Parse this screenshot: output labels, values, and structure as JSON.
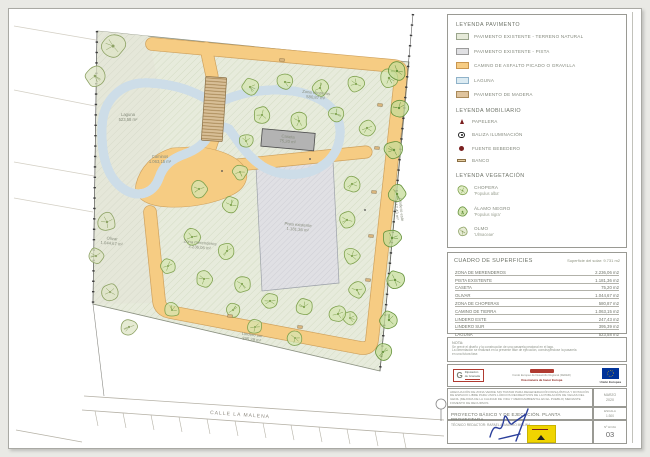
{
  "legend_pavimento": {
    "title": "LEYENDA PAVIMENTO",
    "items": [
      {
        "label": "PAVIMENTO EXISTENTE - TERRENO NATURAL",
        "color": "#e6ead9",
        "border": "#9aa58c"
      },
      {
        "label": "PAVIMENTO EXISTENTE - PISTA",
        "color": "#e0e0e3",
        "border": "#9b9b9b"
      },
      {
        "label": "CAMINO DE ASFALTO PICADO O GRAVILLA",
        "color": "#f6cc83",
        "border": "#c9964f"
      },
      {
        "label": "LAGUNA",
        "color": "#dcebf2",
        "border": "#8fb2c9"
      },
      {
        "label": "PAVIMENTO DE MADERA",
        "color": "#dfc49e",
        "border": "#a98a5a"
      }
    ]
  },
  "legend_mobiliario": {
    "title": "LEYENDA MOBILIARIO",
    "items": [
      {
        "label": "PAPELERA",
        "icon": "papelera-icon",
        "color": "#7a1f1f"
      },
      {
        "label": "BALIZA ILUMINACIÓN",
        "icon": "baliza-icon",
        "color": "#222222"
      },
      {
        "label": "FUENTE BEBEDERO",
        "icon": "fuente-icon",
        "color": "#7a1f1f"
      },
      {
        "label": "BANCO",
        "icon": "banco-icon",
        "color": "#caa36a"
      }
    ]
  },
  "legend_vegetacion": {
    "title": "LEYENDA VEGETACIÓN",
    "items": [
      {
        "label": "CHOPERA",
        "sublabel": "'Populus alba'",
        "type": "c"
      },
      {
        "label": "ÁLAMO NEGRO",
        "sublabel": "'Populus nigra'",
        "type": "a"
      },
      {
        "label": "OLMO",
        "sublabel": "'Ulmaceae'",
        "type": "o"
      }
    ]
  },
  "surfaces": {
    "title": "CUADRO DE SUPERFICIES",
    "subtitle": "Superficie del solar: 9.731 m2",
    "rows": [
      {
        "label": "ZONA DE MERENDEROS",
        "value": "2.236,06 m2"
      },
      {
        "label": "PISTA EXISTENTE",
        "value": "1.181,36 m2"
      },
      {
        "label": "CASETA",
        "value": "75,20 m2"
      },
      {
        "label": "OLIVAR",
        "value": "1.044,67 m2"
      },
      {
        "label": "ZONA DE CHOPERAS",
        "value": "580,87 m2"
      },
      {
        "label": "CAMINO DE TIERRA",
        "value": "1.063,15 m2"
      },
      {
        "label": "LINDERO ESTE",
        "value": "247,43 m2"
      },
      {
        "label": "LINDERO SUR",
        "value": "395,39 m2"
      },
      {
        "label": "LAGUNA",
        "value": "523,58 m2"
      },
      {
        "label": "TOTAL",
        "value": "9.487,73 m2",
        "total": true
      }
    ]
  },
  "nota": {
    "title": "NOTA:",
    "lines": [
      "Se prevé el diseño y la construcción de una pasarela peatonal en el lago.",
      "La cimentación se realizará en la presente fase de ejecución, construyéndose la pasarela",
      "en una futura fase."
    ]
  },
  "logos": {
    "diputacion_line1": "Diputación",
    "diputacion_line2": "de Granada",
    "diputacion_g": "G",
    "feder_line1": "Fondo Europeo de Desarrollo Regional (FEDER)",
    "feder_line2": "Una manera de hacer Europa",
    "ue_label": "Unión Europea"
  },
  "titleblock": {
    "project": "ADECUACIÓN DE ZONA VERDE SIN TRATAR PARA REGENERACIÓN PAISAJÍSTICA Y DOTACIÓN DE ESPACIO LIBRE PARA USOS LÚDICOS RECREATIVOS DE LA POBLACIÓN DE VEGAS DEL GENIL (MEJORA DE LA CALIDAD DE VIDA Y MEDIOAMBIENTAL EN EL PUEBLO) MEDIANTE FOMENTO DE RECURSOS",
    "date_label": "MARZO",
    "date_year": "2020",
    "sheet_title": "PROYECTO BÁSICO Y DE EJECUCIÓN. PLANTA PROYECTADA",
    "escala_label": "ESCALA",
    "escala_value": "1:300",
    "tecnico": "TÉCNICO REDACTOR:  RAFAEL ALMAGRO MOLINA",
    "hoja_label": "Nº HOJA",
    "hoja_value": "03"
  },
  "plan": {
    "street_label": "CALLE LA MALENA",
    "labels": [
      {
        "x": 128,
        "y": 116,
        "rot": 0,
        "lines": [
          "Laguna",
          "523,58 m²"
        ]
      },
      {
        "x": 160,
        "y": 158,
        "rot": 0,
        "lines": [
          "Caminos",
          "1.063,15 m²"
        ]
      },
      {
        "x": 316,
        "y": 94,
        "rot": 5,
        "lines": [
          "Zona choperas",
          "580,87 m²"
        ]
      },
      {
        "x": 200,
        "y": 244,
        "rot": 5,
        "lines": [
          "Zona merenderos",
          "2.236,06 m²"
        ]
      },
      {
        "x": 112,
        "y": 240,
        "rot": 5,
        "lines": [
          "Olivar",
          "1.044,67 m²"
        ]
      },
      {
        "x": 298,
        "y": 226,
        "rot": 5,
        "lines": [
          "Pista existente",
          "1.181,36 m²"
        ]
      },
      {
        "x": 288,
        "y": 138,
        "rot": 5,
        "lines": [
          "Caseta",
          "75,20 m²"
        ]
      },
      {
        "x": 252,
        "y": 336,
        "rot": 7,
        "lines": [
          "Lindero sur",
          "395,39 m²"
        ]
      },
      {
        "x": 400,
        "y": 210,
        "rot": 84,
        "lines": [
          "Lindero este",
          "247,43 m²"
        ]
      }
    ],
    "trees": [
      [
        113,
        46,
        13,
        "o"
      ],
      [
        95,
        76,
        11,
        "o"
      ],
      [
        107,
        222,
        10,
        "o"
      ],
      [
        96,
        256,
        9,
        "o"
      ],
      [
        110,
        292,
        9,
        "o"
      ],
      [
        129,
        327,
        9,
        "o"
      ],
      [
        250,
        87,
        9,
        "c"
      ],
      [
        285,
        82,
        9,
        "c"
      ],
      [
        320,
        88,
        9,
        "c"
      ],
      [
        356,
        84,
        9,
        "c"
      ],
      [
        389,
        78,
        10,
        "c"
      ],
      [
        262,
        115,
        9,
        "c"
      ],
      [
        299,
        121,
        9,
        "c"
      ],
      [
        336,
        114,
        9,
        "c"
      ],
      [
        367,
        128,
        9,
        "c"
      ],
      [
        246,
        141,
        8,
        "c"
      ],
      [
        352,
        184,
        9,
        "c"
      ],
      [
        347,
        220,
        9,
        "c"
      ],
      [
        352,
        256,
        9,
        "c"
      ],
      [
        357,
        290,
        9,
        "c"
      ],
      [
        350,
        318,
        8,
        "c"
      ],
      [
        397,
        71,
        10,
        "a"
      ],
      [
        399,
        108,
        10,
        "a"
      ],
      [
        394,
        150,
        10,
        "a"
      ],
      [
        397,
        194,
        10,
        "a"
      ],
      [
        392,
        238,
        10,
        "a"
      ],
      [
        395,
        280,
        10,
        "a"
      ],
      [
        389,
        320,
        10,
        "a"
      ],
      [
        383,
        352,
        9,
        "a"
      ],
      [
        199,
        189,
        9,
        "c"
      ],
      [
        231,
        205,
        9,
        "c"
      ],
      [
        192,
        237,
        9,
        "c"
      ],
      [
        227,
        251,
        9,
        "c"
      ],
      [
        204,
        279,
        9,
        "c"
      ],
      [
        242,
        284,
        9,
        "c"
      ],
      [
        168,
        266,
        8,
        "c"
      ],
      [
        270,
        301,
        9,
        "c"
      ],
      [
        304,
        307,
        9,
        "c"
      ],
      [
        338,
        314,
        9,
        "c"
      ],
      [
        233,
        310,
        8,
        "c"
      ],
      [
        172,
        310,
        8,
        "c"
      ],
      [
        255,
        327,
        8,
        "c"
      ],
      [
        295,
        338,
        8,
        "c"
      ],
      [
        240,
        172,
        8,
        "c"
      ]
    ],
    "furniture": [
      [
        282,
        60
      ],
      [
        380,
        105
      ],
      [
        377,
        148
      ],
      [
        374,
        192
      ],
      [
        371,
        236
      ],
      [
        368,
        280
      ],
      [
        230,
        316
      ],
      [
        300,
        327
      ]
    ],
    "dots": [
      [
        222,
        171
      ],
      [
        310,
        159
      ],
      [
        365,
        210
      ]
    ]
  }
}
